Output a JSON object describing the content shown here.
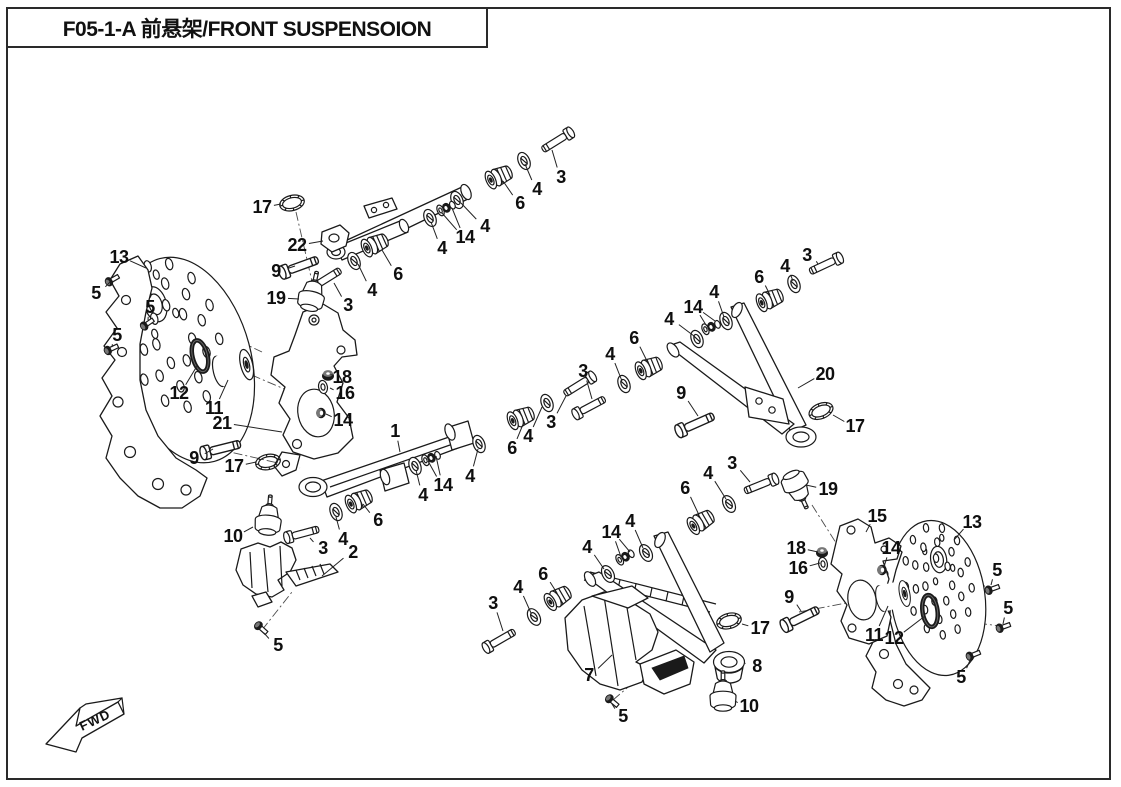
{
  "page": {
    "title": "F05-1-A 前悬架/FRONT SUSPENSOION",
    "fwd_label": "FWD"
  },
  "diagram": {
    "description": "Exploded view parts diagram of ATV front suspension with numbered callouts",
    "callouts": [
      {
        "n": "13",
        "x": 119,
        "y": 257,
        "tx": 146,
        "ty": 268
      },
      {
        "n": "5",
        "x": 96,
        "y": 293,
        "tx": 110,
        "ty": 282
      },
      {
        "n": "5",
        "x": 150,
        "y": 307,
        "tx": 148,
        "ty": 320
      },
      {
        "n": "5",
        "x": 117,
        "y": 335,
        "tx": 112,
        "ty": 347
      },
      {
        "n": "12",
        "x": 179,
        "y": 393,
        "tx": 197,
        "ty": 366
      },
      {
        "n": "11",
        "x": 214,
        "y": 408,
        "tx": 228,
        "ty": 380
      },
      {
        "n": "21",
        "x": 222,
        "y": 423,
        "tx": 282,
        "ty": 432
      },
      {
        "n": "9",
        "x": 194,
        "y": 458,
        "tx": 213,
        "ty": 449
      },
      {
        "n": "17",
        "x": 234,
        "y": 466,
        "tx": 256,
        "ty": 462
      },
      {
        "n": "18",
        "x": 342,
        "y": 377,
        "tx": 333,
        "ty": 375
      },
      {
        "n": "16",
        "x": 345,
        "y": 393,
        "tx": 330,
        "ty": 388
      },
      {
        "n": "14",
        "x": 343,
        "y": 420,
        "tx": 326,
        "ty": 414
      },
      {
        "n": "17",
        "x": 262,
        "y": 207,
        "tx": 281,
        "ty": 204
      },
      {
        "n": "22",
        "x": 297,
        "y": 245,
        "tx": 323,
        "ty": 241
      },
      {
        "n": "9",
        "x": 276,
        "y": 271,
        "tx": 295,
        "ty": 266
      },
      {
        "n": "19",
        "x": 276,
        "y": 298,
        "tx": 299,
        "ty": 299
      },
      {
        "n": "3",
        "x": 348,
        "y": 305,
        "tx": 334,
        "ty": 283
      },
      {
        "n": "4",
        "x": 372,
        "y": 290,
        "tx": 358,
        "ty": 264
      },
      {
        "n": "6",
        "x": 398,
        "y": 274,
        "tx": 382,
        "ty": 250
      },
      {
        "n": "4",
        "x": 442,
        "y": 248,
        "tx": 431,
        "ty": 222
      },
      {
        "n": "14",
        "x": 465,
        "y": 237,
        "tx": 442,
        "ty": 213,
        "tx2": 452,
        "ty2": 208
      },
      {
        "n": "4",
        "x": 485,
        "y": 226,
        "tx": 461,
        "ty": 203
      },
      {
        "n": "6",
        "x": 520,
        "y": 203,
        "tx": 503,
        "ty": 181
      },
      {
        "n": "4",
        "x": 537,
        "y": 189,
        "tx": 525,
        "ty": 164
      },
      {
        "n": "3",
        "x": 561,
        "y": 177,
        "tx": 552,
        "ty": 150
      },
      {
        "n": "3",
        "x": 807,
        "y": 255,
        "tx": 818,
        "ty": 264
      },
      {
        "n": "4",
        "x": 785,
        "y": 266,
        "tx": 793,
        "ty": 281
      },
      {
        "n": "6",
        "x": 759,
        "y": 277,
        "tx": 770,
        "ty": 295
      },
      {
        "n": "4",
        "x": 714,
        "y": 292,
        "tx": 724,
        "ty": 317
      },
      {
        "n": "14",
        "x": 693,
        "y": 307,
        "tx": 706,
        "ty": 325,
        "tx2": 715,
        "ty2": 321
      },
      {
        "n": "4",
        "x": 669,
        "y": 319,
        "tx": 694,
        "ty": 336
      },
      {
        "n": "6",
        "x": 634,
        "y": 338,
        "tx": 648,
        "ty": 363
      },
      {
        "n": "4",
        "x": 610,
        "y": 354,
        "tx": 622,
        "ty": 381
      },
      {
        "n": "3",
        "x": 583,
        "y": 371,
        "tx": 592,
        "ty": 399
      },
      {
        "n": "9",
        "x": 681,
        "y": 393,
        "tx": 698,
        "ty": 416
      },
      {
        "n": "20",
        "x": 825,
        "y": 374,
        "tx": 798,
        "ty": 388
      },
      {
        "n": "17",
        "x": 855,
        "y": 426,
        "tx": 833,
        "ty": 415
      },
      {
        "n": "1",
        "x": 395,
        "y": 431,
        "tx": 400,
        "ty": 452
      },
      {
        "n": "3",
        "x": 551,
        "y": 422,
        "tx": 566,
        "ty": 396
      },
      {
        "n": "4",
        "x": 528,
        "y": 436,
        "tx": 542,
        "ty": 407
      },
      {
        "n": "6",
        "x": 512,
        "y": 448,
        "tx": 524,
        "ty": 422
      },
      {
        "n": "4",
        "x": 470,
        "y": 476,
        "tx": 478,
        "ty": 449
      },
      {
        "n": "14",
        "x": 443,
        "y": 485,
        "tx": 428,
        "ty": 461,
        "tx2": 436,
        "ty2": 456
      },
      {
        "n": "4",
        "x": 423,
        "y": 495,
        "tx": 416,
        "ty": 470
      },
      {
        "n": "6",
        "x": 378,
        "y": 520,
        "tx": 363,
        "ty": 504
      },
      {
        "n": "4",
        "x": 343,
        "y": 539,
        "tx": 336,
        "ty": 517
      },
      {
        "n": "3",
        "x": 323,
        "y": 548,
        "tx": 310,
        "ty": 538
      },
      {
        "n": "2",
        "x": 353,
        "y": 552,
        "tx": 322,
        "ty": 576
      },
      {
        "n": "10",
        "x": 233,
        "y": 536,
        "tx": 253,
        "ty": 527
      },
      {
        "n": "5",
        "x": 278,
        "y": 645,
        "tx": 264,
        "ty": 633
      },
      {
        "n": "3",
        "x": 732,
        "y": 463,
        "tx": 750,
        "ty": 482
      },
      {
        "n": "4",
        "x": 708,
        "y": 473,
        "tx": 726,
        "ty": 499
      },
      {
        "n": "6",
        "x": 685,
        "y": 488,
        "tx": 699,
        "ty": 515
      },
      {
        "n": "4",
        "x": 630,
        "y": 521,
        "tx": 643,
        "ty": 548
      },
      {
        "n": "14",
        "x": 611,
        "y": 532,
        "tx": 621,
        "ty": 557,
        "tx2": 630,
        "ty2": 552
      },
      {
        "n": "4",
        "x": 587,
        "y": 547,
        "tx": 604,
        "ty": 569
      },
      {
        "n": "6",
        "x": 543,
        "y": 574,
        "tx": 557,
        "ty": 593
      },
      {
        "n": "4",
        "x": 518,
        "y": 587,
        "tx": 531,
        "ty": 613
      },
      {
        "n": "3",
        "x": 493,
        "y": 603,
        "tx": 503,
        "ty": 631
      },
      {
        "n": "7",
        "x": 589,
        "y": 675,
        "tx": 612,
        "ty": 655
      },
      {
        "n": "5",
        "x": 623,
        "y": 716,
        "tx": 612,
        "ty": 704
      },
      {
        "n": "17",
        "x": 760,
        "y": 628,
        "tx": 742,
        "ty": 624
      },
      {
        "n": "8",
        "x": 757,
        "y": 666,
        "tx": 745,
        "ty": 663
      },
      {
        "n": "10",
        "x": 749,
        "y": 706,
        "tx": 735,
        "ty": 701
      },
      {
        "n": "19",
        "x": 828,
        "y": 489,
        "tx": 806,
        "ty": 485
      },
      {
        "n": "15",
        "x": 877,
        "y": 516,
        "tx": 866,
        "ty": 532
      },
      {
        "n": "18",
        "x": 796,
        "y": 548,
        "tx": 818,
        "ty": 552
      },
      {
        "n": "16",
        "x": 798,
        "y": 568,
        "tx": 820,
        "ty": 563
      },
      {
        "n": "14",
        "x": 891,
        "y": 548,
        "tx": 884,
        "ty": 567
      },
      {
        "n": "9",
        "x": 789,
        "y": 597,
        "tx": 801,
        "ty": 611
      },
      {
        "n": "11",
        "x": 874,
        "y": 635,
        "tx": 888,
        "ty": 606
      },
      {
        "n": "12",
        "x": 894,
        "y": 638,
        "tx": 925,
        "ty": 616
      },
      {
        "n": "13",
        "x": 972,
        "y": 522,
        "tx": 954,
        "ty": 540
      },
      {
        "n": "5",
        "x": 997,
        "y": 570,
        "tx": 991,
        "ty": 585
      },
      {
        "n": "5",
        "x": 1008,
        "y": 608,
        "tx": 1003,
        "ty": 624
      },
      {
        "n": "5",
        "x": 961,
        "y": 677,
        "tx": 971,
        "ty": 658
      }
    ],
    "discs": [
      {
        "name": "brake-disc-left",
        "x": 187,
        "y": 360,
        "rx": 64,
        "ry": 105,
        "rot": -15,
        "hx": -16,
        "hy": -62
      },
      {
        "name": "brake-disc-right",
        "x": 938,
        "y": 598,
        "rx": 47,
        "ry": 78,
        "rot": -8,
        "hx": 6,
        "hy": -38
      }
    ],
    "parts": [
      {
        "type": "bolt",
        "x": 331,
        "y": 276,
        "rot": -32
      },
      {
        "type": "bolt",
        "x": 552,
        "y": 144,
        "rot": 148
      },
      {
        "type": "bolt",
        "x": 820,
        "y": 267,
        "rot": 155
      },
      {
        "type": "bolt",
        "x": 595,
        "y": 404,
        "rot": -28
      },
      {
        "type": "bolt",
        "x": 574,
        "y": 388,
        "rot": 148
      },
      {
        "type": "bolt",
        "x": 308,
        "y": 532,
        "rot": -15
      },
      {
        "type": "bolt",
        "x": 755,
        "y": 487,
        "rot": 158
      },
      {
        "type": "bolt",
        "x": 505,
        "y": 637,
        "rot": -30
      },
      {
        "type": "bolt",
        "x": 306,
        "y": 264,
        "rot": -20,
        "s": 1.15
      },
      {
        "type": "bolt",
        "x": 228,
        "y": 447,
        "rot": -14,
        "s": 1.15
      },
      {
        "type": "bolt",
        "x": 702,
        "y": 421,
        "rot": -24,
        "s": 1.15
      },
      {
        "type": "bolt",
        "x": 807,
        "y": 615,
        "rot": -26,
        "s": 1.15
      },
      {
        "type": "bolt5",
        "x": 112,
        "y": 280,
        "rot": -30
      },
      {
        "type": "bolt5",
        "x": 147,
        "y": 324,
        "rot": -35
      },
      {
        "type": "bolt5",
        "x": 111,
        "y": 349,
        "rot": -25
      },
      {
        "type": "bolt5",
        "x": 261,
        "y": 628,
        "rot": 42
      },
      {
        "type": "bolt5",
        "x": 612,
        "y": 701,
        "rot": 40
      },
      {
        "type": "bolt5",
        "x": 992,
        "y": 589,
        "rot": -20
      },
      {
        "type": "bolt5",
        "x": 1003,
        "y": 627,
        "rot": -20
      },
      {
        "type": "bolt5",
        "x": 973,
        "y": 655,
        "rot": -22
      },
      {
        "type": "washer",
        "x": 354,
        "y": 261,
        "rot": -24
      },
      {
        "type": "washer",
        "x": 457,
        "y": 200,
        "rot": -24
      },
      {
        "type": "washer",
        "x": 430,
        "y": 218,
        "rot": -24
      },
      {
        "type": "washer",
        "x": 524,
        "y": 161,
        "rot": -24
      },
      {
        "type": "washer",
        "x": 794,
        "y": 284,
        "rot": -22
      },
      {
        "type": "washer",
        "x": 726,
        "y": 321,
        "rot": -22
      },
      {
        "type": "washer",
        "x": 697,
        "y": 339,
        "rot": -22
      },
      {
        "type": "washer",
        "x": 624,
        "y": 384,
        "rot": -22
      },
      {
        "type": "washer",
        "x": 547,
        "y": 403,
        "rot": -22
      },
      {
        "type": "washer",
        "x": 479,
        "y": 444,
        "rot": -22
      },
      {
        "type": "washer",
        "x": 415,
        "y": 466,
        "rot": -22
      },
      {
        "type": "washer",
        "x": 336,
        "y": 512,
        "rot": -22
      },
      {
        "type": "washer",
        "x": 729,
        "y": 504,
        "rot": -28
      },
      {
        "type": "washer",
        "x": 646,
        "y": 553,
        "rot": -28
      },
      {
        "type": "washer",
        "x": 608,
        "y": 574,
        "rot": -28
      },
      {
        "type": "washer",
        "x": 534,
        "y": 617,
        "rot": -30
      },
      {
        "type": "washer16",
        "x": 323,
        "y": 387,
        "rot": -10
      },
      {
        "type": "washer16",
        "x": 823,
        "y": 564,
        "rot": -10
      },
      {
        "type": "bushing",
        "x": 376,
        "y": 244,
        "rot": -24
      },
      {
        "type": "bushing",
        "x": 500,
        "y": 176,
        "rot": -24
      },
      {
        "type": "bushing",
        "x": 771,
        "y": 299,
        "rot": -22
      },
      {
        "type": "bushing",
        "x": 650,
        "y": 367,
        "rot": -22
      },
      {
        "type": "bushing",
        "x": 522,
        "y": 417,
        "rot": -22
      },
      {
        "type": "bushing",
        "x": 360,
        "y": 500,
        "rot": -24
      },
      {
        "type": "bushing",
        "x": 702,
        "y": 521,
        "rot": -30
      },
      {
        "type": "bushing",
        "x": 559,
        "y": 597,
        "rot": -30
      },
      {
        "type": "stack14",
        "x": 446,
        "y": 208,
        "rot": -24
      },
      {
        "type": "stack14",
        "x": 711,
        "y": 327,
        "rot": -22
      },
      {
        "type": "stack14",
        "x": 431,
        "y": 458,
        "rot": -22
      },
      {
        "type": "stack14",
        "x": 625,
        "y": 557,
        "rot": -28
      },
      {
        "type": "nut14",
        "x": 321,
        "y": 413,
        "rot": 0
      },
      {
        "type": "nut14",
        "x": 882,
        "y": 570,
        "rot": 0
      },
      {
        "type": "nut18",
        "x": 328,
        "y": 375,
        "rot": 0
      },
      {
        "type": "nut18",
        "x": 822,
        "y": 552,
        "rot": 0
      },
      {
        "type": "oring17",
        "x": 292,
        "y": 203,
        "rot": -14
      },
      {
        "type": "oring17",
        "x": 268,
        "y": 462,
        "rot": -12
      },
      {
        "type": "oring17",
        "x": 821,
        "y": 411,
        "rot": -22
      },
      {
        "type": "oring17",
        "x": 729,
        "y": 621,
        "rot": -15
      },
      {
        "type": "oring12",
        "x": 200,
        "y": 356,
        "rot": -14
      },
      {
        "type": "oring12",
        "x": 930,
        "y": 611,
        "rot": -8
      },
      {
        "type": "balljoint",
        "x": 311,
        "y": 299,
        "rot": 12
      },
      {
        "type": "balljoint",
        "x": 268,
        "y": 523,
        "rot": 5
      },
      {
        "type": "balljoint",
        "x": 795,
        "y": 483,
        "rot": 155
      },
      {
        "type": "balljoint",
        "x": 723,
        "y": 699,
        "rot": 0
      },
      {
        "type": "cyl11",
        "x": 233,
        "y": 368,
        "rot": -14
      },
      {
        "type": "cyl11",
        "x": 893,
        "y": 596,
        "rot": -12,
        "s": 0.85
      }
    ],
    "axes": [
      {
        "x1": 116,
        "y1": 283,
        "x2": 262,
        "y2": 352
      },
      {
        "x1": 152,
        "y1": 327,
        "x2": 240,
        "y2": 385
      },
      {
        "x1": 115,
        "y1": 352,
        "x2": 225,
        "y2": 420
      },
      {
        "x1": 205,
        "y1": 355,
        "x2": 310,
        "y2": 400
      },
      {
        "x1": 217,
        "y1": 449,
        "x2": 300,
        "y2": 468
      },
      {
        "x1": 296,
        "y1": 212,
        "x2": 314,
        "y2": 290
      },
      {
        "x1": 262,
        "y1": 630,
        "x2": 292,
        "y2": 592
      },
      {
        "x1": 613,
        "y1": 700,
        "x2": 648,
        "y2": 670
      },
      {
        "x1": 799,
        "y1": 612,
        "x2": 862,
        "y2": 600
      },
      {
        "x1": 812,
        "y1": 505,
        "x2": 838,
        "y2": 546
      },
      {
        "x1": 852,
        "y1": 586,
        "x2": 988,
        "y2": 586
      },
      {
        "x1": 860,
        "y1": 608,
        "x2": 1000,
        "y2": 626
      },
      {
        "x1": 868,
        "y1": 636,
        "x2": 968,
        "y2": 656
      }
    ]
  }
}
